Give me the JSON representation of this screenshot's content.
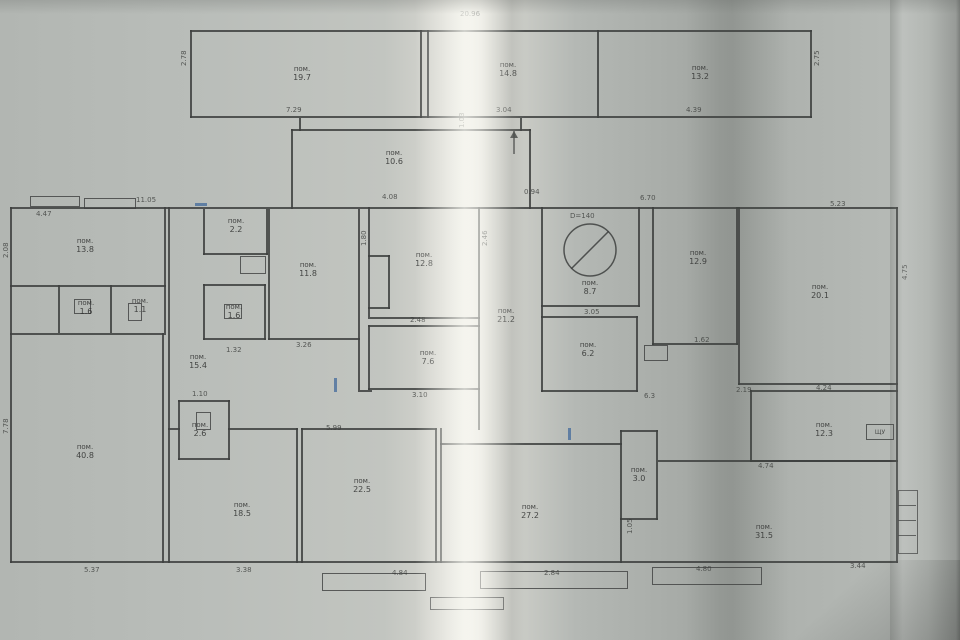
{
  "colors": {
    "paper": "#b4b8b4",
    "ink": "#3d3f3e",
    "blue_ink": "#4a6f9e",
    "text": "#2e2f2e"
  },
  "plan": {
    "rooms": [
      {
        "prefix": "пом.",
        "area": "19.7",
        "cx": 302,
        "cy": 74
      },
      {
        "prefix": "пом.",
        "area": "14.8",
        "cx": 508,
        "cy": 70
      },
      {
        "prefix": "пом.",
        "area": "13.2",
        "cx": 700,
        "cy": 73
      },
      {
        "prefix": "пом.",
        "area": "10.6",
        "cx": 394,
        "cy": 158
      },
      {
        "prefix": "пом.",
        "area": "13.8",
        "cx": 85,
        "cy": 246
      },
      {
        "prefix": "пом.",
        "area": "1.6",
        "cx": 86,
        "cy": 308
      },
      {
        "prefix": "пом.",
        "area": "1.1",
        "cx": 140,
        "cy": 306
      },
      {
        "prefix": "пом.",
        "area": "40.8",
        "cx": 85,
        "cy": 452
      },
      {
        "prefix": "пом.",
        "area": "2.2",
        "cx": 236,
        "cy": 226
      },
      {
        "prefix": "пом.",
        "area": "1.6",
        "cx": 234,
        "cy": 312
      },
      {
        "prefix": "пом.",
        "area": "11.8",
        "cx": 308,
        "cy": 270
      },
      {
        "prefix": "пом.",
        "area": "15.4",
        "cx": 198,
        "cy": 362
      },
      {
        "prefix": "пом.",
        "area": "2.6",
        "cx": 200,
        "cy": 430
      },
      {
        "prefix": "пом.",
        "area": "18.5",
        "cx": 242,
        "cy": 510
      },
      {
        "prefix": "пом.",
        "area": "22.5",
        "cx": 362,
        "cy": 486
      },
      {
        "prefix": "пом.",
        "area": "12.8",
        "cx": 424,
        "cy": 260
      },
      {
        "prefix": "пом.",
        "area": "7.6",
        "cx": 428,
        "cy": 358
      },
      {
        "prefix": "пом.",
        "area": "21.2",
        "cx": 506,
        "cy": 316
      },
      {
        "prefix": "пом.",
        "area": "8.7",
        "cx": 590,
        "cy": 288
      },
      {
        "prefix": "пом.",
        "area": "12.9",
        "cx": 698,
        "cy": 258
      },
      {
        "prefix": "пом.",
        "area": "6.2",
        "cx": 588,
        "cy": 350
      },
      {
        "prefix": "пом.",
        "area": "20.1",
        "cx": 820,
        "cy": 292
      },
      {
        "prefix": "пом.",
        "area": "3.0",
        "cx": 639,
        "cy": 475
      },
      {
        "prefix": "пом.",
        "area": "27.2",
        "cx": 530,
        "cy": 512
      },
      {
        "prefix": "пом.",
        "area": "12.3",
        "cx": 824,
        "cy": 430
      },
      {
        "prefix": "пом.",
        "area": "31.5",
        "cx": 764,
        "cy": 532
      }
    ],
    "dims": [
      {
        "x": 460,
        "y": 10,
        "t": "20.96"
      },
      {
        "x": 286,
        "y": 106,
        "t": "7.29"
      },
      {
        "x": 496,
        "y": 106,
        "t": "3.04"
      },
      {
        "x": 686,
        "y": 106,
        "t": "4.39"
      },
      {
        "x": 180,
        "y": 66,
        "t": "2.78",
        "r": 1
      },
      {
        "x": 813,
        "y": 66,
        "t": "2.75",
        "r": 1
      },
      {
        "x": 382,
        "y": 193,
        "t": "4.08"
      },
      {
        "x": 458,
        "y": 128,
        "t": "1.03",
        "r": 1
      },
      {
        "x": 136,
        "y": 196,
        "t": "11.05"
      },
      {
        "x": 36,
        "y": 210,
        "t": "4.47"
      },
      {
        "x": 640,
        "y": 194,
        "t": "6.70"
      },
      {
        "x": 830,
        "y": 200,
        "t": "5.23"
      },
      {
        "x": 901,
        "y": 280,
        "t": "4.75",
        "r": 1
      },
      {
        "x": 2,
        "y": 258,
        "t": "2.08",
        "r": 1
      },
      {
        "x": 2,
        "y": 434,
        "t": "7.78",
        "r": 1
      },
      {
        "x": 84,
        "y": 566,
        "t": "5.37"
      },
      {
        "x": 236,
        "y": 566,
        "t": "3.38"
      },
      {
        "x": 392,
        "y": 569,
        "t": "4.84"
      },
      {
        "x": 544,
        "y": 569,
        "t": "2.84"
      },
      {
        "x": 696,
        "y": 565,
        "t": "4.80"
      },
      {
        "x": 850,
        "y": 562,
        "t": "3.44"
      },
      {
        "x": 296,
        "y": 341,
        "t": "3.26"
      },
      {
        "x": 410,
        "y": 316,
        "t": "2.48"
      },
      {
        "x": 412,
        "y": 391,
        "t": "3.10"
      },
      {
        "x": 584,
        "y": 308,
        "t": "3.05"
      },
      {
        "x": 570,
        "y": 212,
        "t": "D=140"
      },
      {
        "x": 644,
        "y": 392,
        "t": "6.3"
      },
      {
        "x": 736,
        "y": 386,
        "t": "2.19"
      },
      {
        "x": 816,
        "y": 384,
        "t": "4.24"
      },
      {
        "x": 758,
        "y": 462,
        "t": "4.74"
      },
      {
        "x": 626,
        "y": 534,
        "t": "1.05",
        "r": 1
      },
      {
        "x": 326,
        "y": 424,
        "t": "5.99"
      },
      {
        "x": 192,
        "y": 390,
        "t": "1.10"
      },
      {
        "x": 226,
        "y": 346,
        "t": "1.32"
      },
      {
        "x": 360,
        "y": 246,
        "t": "1.80",
        "r": 1
      },
      {
        "x": 481,
        "y": 246,
        "t": "2.46",
        "r": 1
      },
      {
        "x": 524,
        "y": 188,
        "t": "0.94"
      },
      {
        "x": 694,
        "y": 336,
        "t": "1.62"
      }
    ],
    "walls": [
      [
        190,
        30,
        622,
        2
      ],
      [
        190,
        116,
        622,
        2
      ],
      [
        190,
        30,
        2,
        88
      ],
      [
        810,
        30,
        2,
        88
      ],
      [
        420,
        30,
        2,
        88
      ],
      [
        427,
        30,
        2,
        88
      ],
      [
        597,
        30,
        2,
        88
      ],
      [
        299,
        118,
        2,
        13
      ],
      [
        520,
        118,
        2,
        13
      ],
      [
        291,
        129,
        240,
        2
      ],
      [
        291,
        129,
        2,
        80
      ],
      [
        529,
        129,
        2,
        80
      ],
      [
        10,
        207,
        888,
        2
      ],
      [
        896,
        207,
        2,
        356
      ],
      [
        10,
        561,
        888,
        2
      ],
      [
        10,
        207,
        2,
        356
      ],
      [
        164,
        207,
        2,
        126
      ],
      [
        10,
        285,
        156,
        2
      ],
      [
        58,
        285,
        2,
        48
      ],
      [
        110,
        285,
        2,
        48
      ],
      [
        10,
        333,
        156,
        2
      ],
      [
        162,
        333,
        2,
        230
      ],
      [
        168,
        207,
        2,
        356
      ],
      [
        203,
        209,
        2,
        46
      ],
      [
        266,
        209,
        2,
        46
      ],
      [
        203,
        253,
        65,
        2
      ],
      [
        268,
        209,
        2,
        131
      ],
      [
        358,
        209,
        2,
        131
      ],
      [
        268,
        338,
        92,
        2
      ],
      [
        203,
        284,
        63,
        2
      ],
      [
        203,
        284,
        2,
        56
      ],
      [
        264,
        284,
        2,
        56
      ],
      [
        203,
        338,
        63,
        2
      ],
      [
        168,
        428,
        12,
        2
      ],
      [
        228,
        428,
        70,
        2
      ],
      [
        178,
        400,
        52,
        2
      ],
      [
        178,
        400,
        2,
        60
      ],
      [
        228,
        400,
        2,
        60
      ],
      [
        178,
        458,
        52,
        2
      ],
      [
        296,
        428,
        2,
        135
      ],
      [
        301,
        428,
        2,
        135
      ],
      [
        301,
        428,
        136,
        2
      ],
      [
        435,
        428,
        2,
        135
      ],
      [
        440,
        428,
        2,
        135
      ],
      [
        440,
        443,
        182,
        2
      ],
      [
        358,
        340,
        2,
        50
      ],
      [
        358,
        390,
        14,
        2
      ],
      [
        368,
        207,
        2,
        110
      ],
      [
        478,
        207,
        2,
        223
      ],
      [
        368,
        317,
        112,
        2
      ],
      [
        368,
        325,
        112,
        2
      ],
      [
        368,
        325,
        2,
        65
      ],
      [
        368,
        388,
        112,
        2
      ],
      [
        368,
        255,
        22,
        2
      ],
      [
        368,
        307,
        22,
        2
      ],
      [
        388,
        255,
        2,
        54
      ],
      [
        541,
        207,
        2,
        185
      ],
      [
        541,
        305,
        99,
        2
      ],
      [
        638,
        207,
        2,
        100
      ],
      [
        541,
        316,
        97,
        2
      ],
      [
        541,
        390,
        97,
        2
      ],
      [
        636,
        316,
        2,
        76
      ],
      [
        652,
        207,
        2,
        138
      ],
      [
        736,
        207,
        2,
        138
      ],
      [
        652,
        343,
        86,
        2
      ],
      [
        738,
        207,
        2,
        178
      ],
      [
        738,
        383,
        160,
        2
      ],
      [
        750,
        390,
        2,
        72
      ],
      [
        750,
        390,
        148,
        2
      ],
      [
        750,
        460,
        148,
        2
      ],
      [
        658,
        460,
        240,
        2
      ],
      [
        620,
        430,
        2,
        90
      ],
      [
        656,
        430,
        2,
        90
      ],
      [
        620,
        430,
        38,
        2
      ],
      [
        620,
        518,
        38,
        2
      ],
      [
        620,
        518,
        2,
        45
      ],
      [
        898,
        505,
        18,
        1
      ],
      [
        898,
        520,
        18,
        1
      ],
      [
        898,
        535,
        18,
        1
      ],
      [
        195,
        203,
        12,
        3,
        "b"
      ],
      [
        334,
        378,
        3,
        14,
        "b"
      ],
      [
        568,
        428,
        3,
        12,
        "b"
      ]
    ],
    "boxes": [
      {
        "x": 644,
        "y": 345,
        "w": 22,
        "h": 14
      },
      {
        "x": 866,
        "y": 424,
        "w": 26,
        "h": 14,
        "label": "ЩУ"
      },
      {
        "x": 30,
        "y": 196,
        "w": 48,
        "h": 9
      },
      {
        "x": 84,
        "y": 198,
        "w": 50,
        "h": 9
      },
      {
        "x": 322,
        "y": 573,
        "w": 102,
        "h": 16
      },
      {
        "x": 480,
        "y": 571,
        "w": 146,
        "h": 16
      },
      {
        "x": 652,
        "y": 567,
        "w": 108,
        "h": 16
      },
      {
        "x": 430,
        "y": 597,
        "w": 72,
        "h": 11
      },
      {
        "x": 898,
        "y": 490,
        "w": 18,
        "h": 62
      },
      {
        "x": 74,
        "y": 299,
        "w": 15,
        "h": 13
      },
      {
        "x": 224,
        "y": 304,
        "w": 16,
        "h": 13
      },
      {
        "x": 128,
        "y": 303,
        "w": 12,
        "h": 16
      },
      {
        "x": 196,
        "y": 412,
        "w": 13,
        "h": 16
      },
      {
        "x": 240,
        "y": 256,
        "w": 24,
        "h": 16
      }
    ],
    "circle": {
      "cx": 590,
      "cy": 250,
      "r": 26
    },
    "arrow": {
      "x": 514,
      "y_tail": 154,
      "y_head": 131
    }
  }
}
